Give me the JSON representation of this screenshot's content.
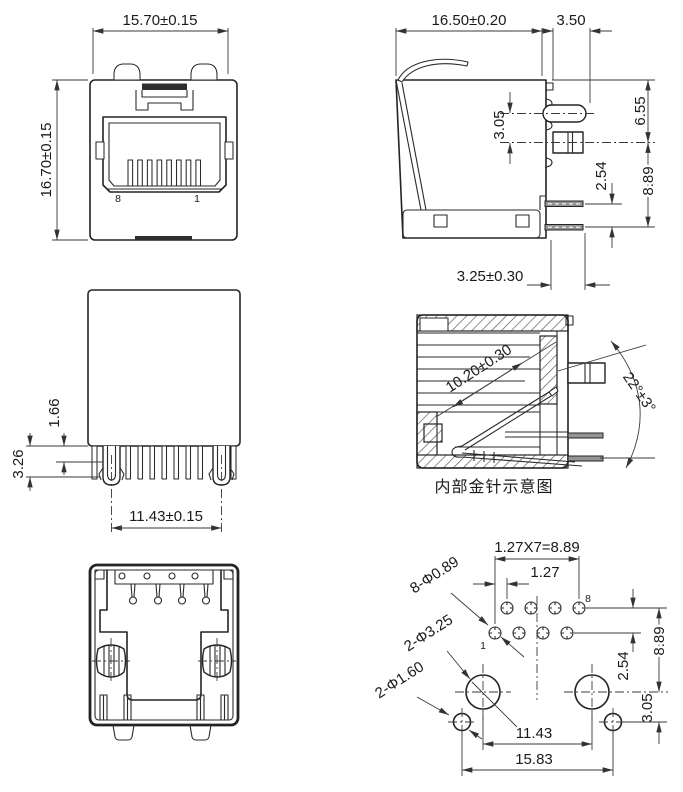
{
  "colors": {
    "background": "#ffffff",
    "line": "#232323",
    "dim_line": "#3a3a3a",
    "pin_fill": "#949494",
    "dark_fill": "#2e2e2e"
  },
  "views": {
    "front": {
      "dim_width": "15.70±0.15",
      "dim_height": "16.70±0.15",
      "label_pin8": "8",
      "label_pin1": "1"
    },
    "side": {
      "dim_depth": "16.50±0.20",
      "dim_tail": "3.50",
      "dim_contact_drop": "3.05",
      "dim_top_to_post": "6.55",
      "dim_pin_pitch": "2.54",
      "dim_post_to_pin": "8.89",
      "dim_pin_offset": "3.25±0.30"
    },
    "rear": {
      "dim_barb": "1.66",
      "dim_peg": "3.26",
      "dim_span": "11.43±0.15"
    },
    "section": {
      "dim_contact_length": "10.20±0.30",
      "dim_contact_angle": "22°±3°",
      "caption": "内部金针示意图"
    },
    "footprint": {
      "dim_total": "1.27X7=8.89",
      "dim_pitch": "1.27",
      "callout_pin_holes": "8-Φ0.89",
      "callout_post_holes": "2-Φ3.25",
      "callout_peg_holes": "2-Φ1.60",
      "dim_row_gap": "2.54",
      "dim_row_to_post": "8.89",
      "dim_post_to_peg": "3.05",
      "dim_post_span": "11.43",
      "dim_peg_span": "15.83",
      "label_pin1": "1",
      "label_pin8": "8"
    }
  }
}
